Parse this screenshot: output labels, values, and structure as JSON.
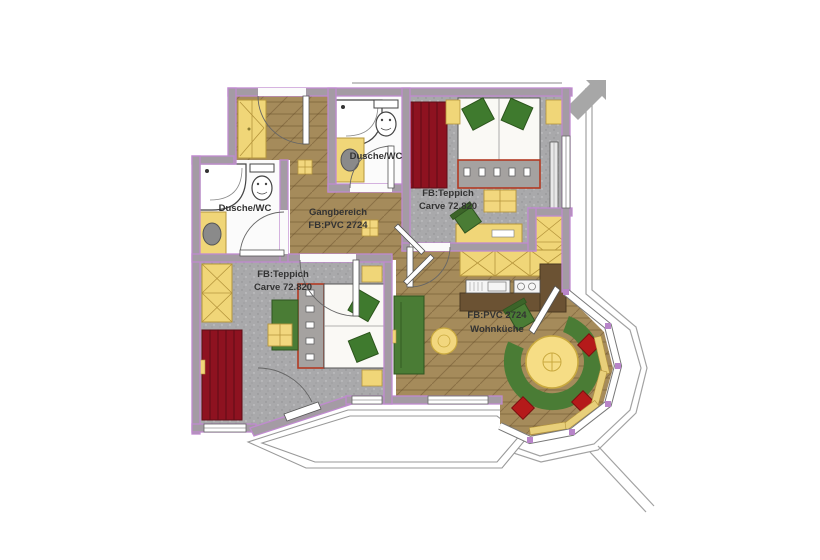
{
  "app": {
    "type": "apartment-floor-plan",
    "background": "#ffffff"
  },
  "rooms": {
    "bath_left": {
      "label": "Dusche/WC"
    },
    "bath_top": {
      "label": "Dusche/WC"
    },
    "corridor": {
      "label_line1": "Gangbereich",
      "label_line2": "FB:PVC 2724"
    },
    "bedroom_top_right": {
      "label_line1": "FB:Teppich",
      "label_line2": "Carve 72.820"
    },
    "bedroom_bottom_left": {
      "label_line1": "FB:Teppich",
      "label_line2": "Carve 72.820"
    },
    "living_kitchen": {
      "label_line1": "FB:PVC 2724",
      "label_line2": "Wohnküche"
    }
  },
  "colors": {
    "wall_fill": "#a49ba4",
    "wall_outline": "#c08ad0",
    "wood_floor": "#a58b5b",
    "carpet_floor": "#a9a9ab",
    "bath_floor": "#fbfbfb",
    "furniture_yellow": "#f0d678",
    "furniture_yellow_outline": "#b5953c",
    "wardrobe_red": "#8e1220",
    "upholstery_green": "#4a7c35",
    "cushion_red": "#b51a1a",
    "bed_frame_red": "#b23a22",
    "counter_brown": "#6b5233",
    "roofline_gray": "#9a9a9a"
  }
}
